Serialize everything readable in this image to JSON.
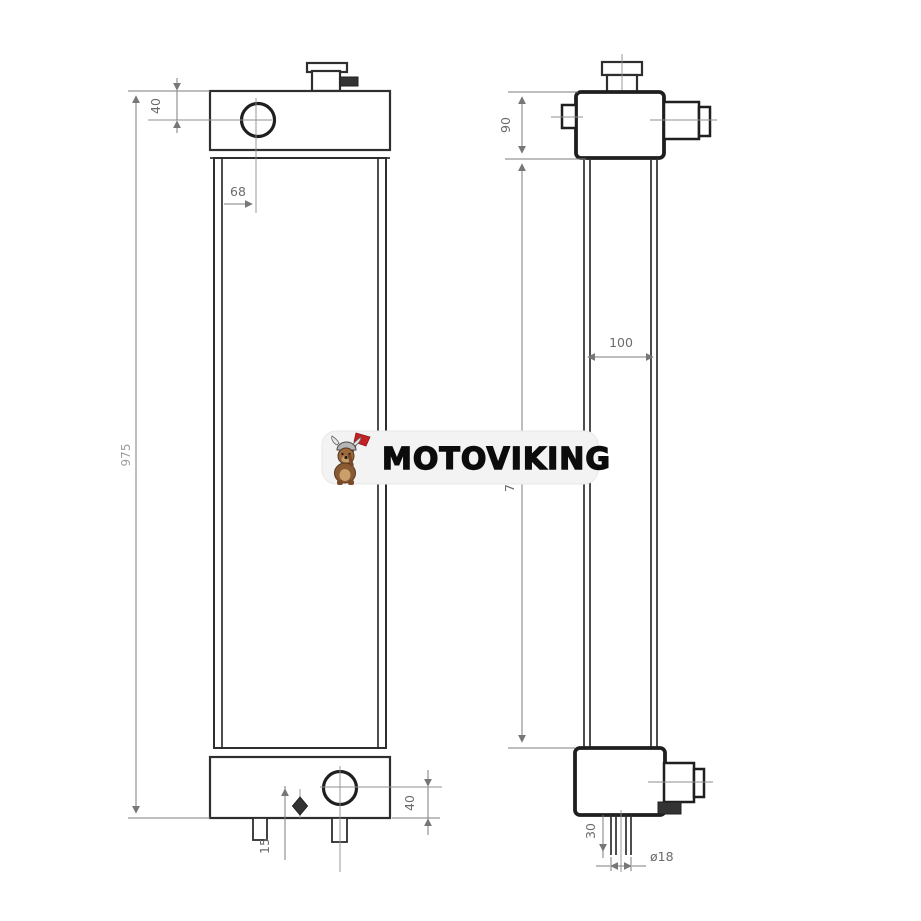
{
  "watermark": {
    "brand": "MOTOVIKING",
    "mascot": "viking-dog-mascot"
  },
  "dimensions": {
    "front": {
      "top_port_offset": "40",
      "filler_offset": "68",
      "overall_height": "975",
      "bottom_port_offset": "40",
      "drain_offset": "15"
    },
    "side": {
      "top_tank_height": "90",
      "core_width": "100",
      "core_height_visible": "7",
      "drain_length": "30",
      "drain_diameter": "ø18"
    }
  },
  "colors": {
    "line": "#2e2e2e",
    "dimension_line": "#7d7d7d",
    "dimension_text": "#6b6b6b",
    "badge_background": "#f3f3f3",
    "brand_text": "#0c0c0c",
    "mascot_flag": "#c32222",
    "mascot_body": "#8a5a33"
  }
}
